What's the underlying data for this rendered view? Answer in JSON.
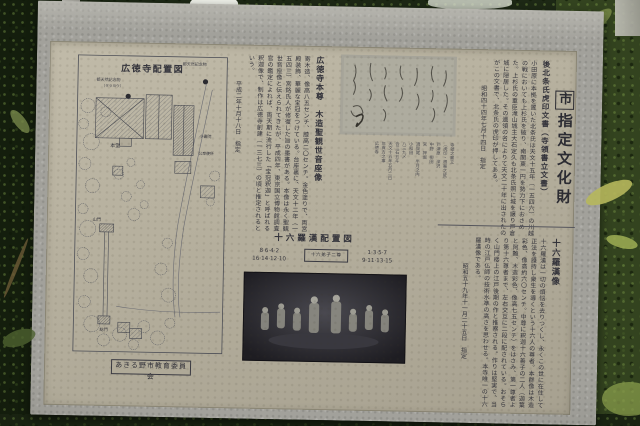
{
  "colors": {
    "panel_beige": "#b5af9d",
    "stone_gray": "#a2a19b",
    "ink": "#32323a",
    "foliage_dark": "#1d2815",
    "foliage_light": "#8ca04e",
    "yellow_leaf": "#b6b75c",
    "photo_dark": "#222126"
  },
  "board": {
    "designation_title_mark": "市",
    "designation_title_rest": "指定文化財",
    "map": {
      "title": "広徳寺配置図",
      "monument_left": "都天然記念物",
      "monument_left_sub": "（タラヨウ）",
      "monument_right": "都天然記念物",
      "label_main_hall": "本堂",
      "label_small_shoin": "小書院",
      "label_restroom": "公衆便所",
      "label_sanmon": "山門",
      "label_somon": "総門",
      "credit": "あきる野市教育委員会"
    },
    "honzon_section": {
      "heading": "広徳寺本尊　木造聖観世音座像",
      "body": "寄木造、像高八五センチ、膝高二〇センチ。金色塗りで、両宮殿装飾、華麗な宝冠をつけている。台座裏に、天文十二年（一五四三）宮銘氏人が修復した旨の墨書がある。本像は永く聖観世音座像と伝えられてきたが、平成四年、東京国立博物館調査官の鑑定によれば、両天期に流行した「宝冠釈迦」と呼ばれる釈迦像で、制作は広徳寺創建（一三七三）の頃と推定されるという。",
      "date_line": "平成二年十月十八日　指定"
    },
    "koin_section": {
      "heading": "後北条氏虎印文書（寺領書立文書）",
      "body": "小田原に本拠を置いた北条氏は天文十五年（一五四六）の川越の戦においても上杉氏を破り、南関東一円を勢力下におさめた。上杉氏の重臣滝山城主大石定久も北条氏照に城を譲り戸倉城に隠居した。その遺領の名によりて天文二十年に出されたのがこの文書で、北条氏の虎印が押してある。",
      "date_line": "昭和四十四年七月十四日　指定"
    },
    "doc_caption": [
      "寺領之書立",
      "（虎印・根案之証）",
      "戸津原　深沢",
      "中野　柳田",
      "宮　押堀",
      "須賀尾　半月之内",
      "小和田",
      "八三九〆",
      "合三石五斗",
      "天文十五年五月二日",
      "年貢方之事",
      "広徳寺"
    ],
    "rakan_diagram": {
      "heading": "十六羅漢配置図",
      "left_top": "8·6·4·2",
      "left_bottom": "16·14·12·10",
      "center_box": "十六弟子二尊",
      "right_top": "1·3·5·7",
      "right_bottom": "9·11·13·15"
    },
    "rakan_section": {
      "heading": "十六羅漢像",
      "body": "十六羅漢は一切の煩悩を去りつくし、永くこの世に在住して正法を護持し衆生を導くという十六人の尊者。本群像は木造彩色、像高約六〇センチ。中尊に釈迦十六善子の二人（迦葉と阿難、木造彩色、像高七五センチ）をはさみ、第一尊者より第十六尊者まで、左右交互に二段に配されている。おそらく山門楼上の江戸後期の作と推察される。作りは堅実で、当時の江戸仏師の技術水準の高さを思わせる。本寺唯一の十六羅漢像である。",
      "date_line": "昭和五十九年十一月二十五日　指定"
    }
  }
}
